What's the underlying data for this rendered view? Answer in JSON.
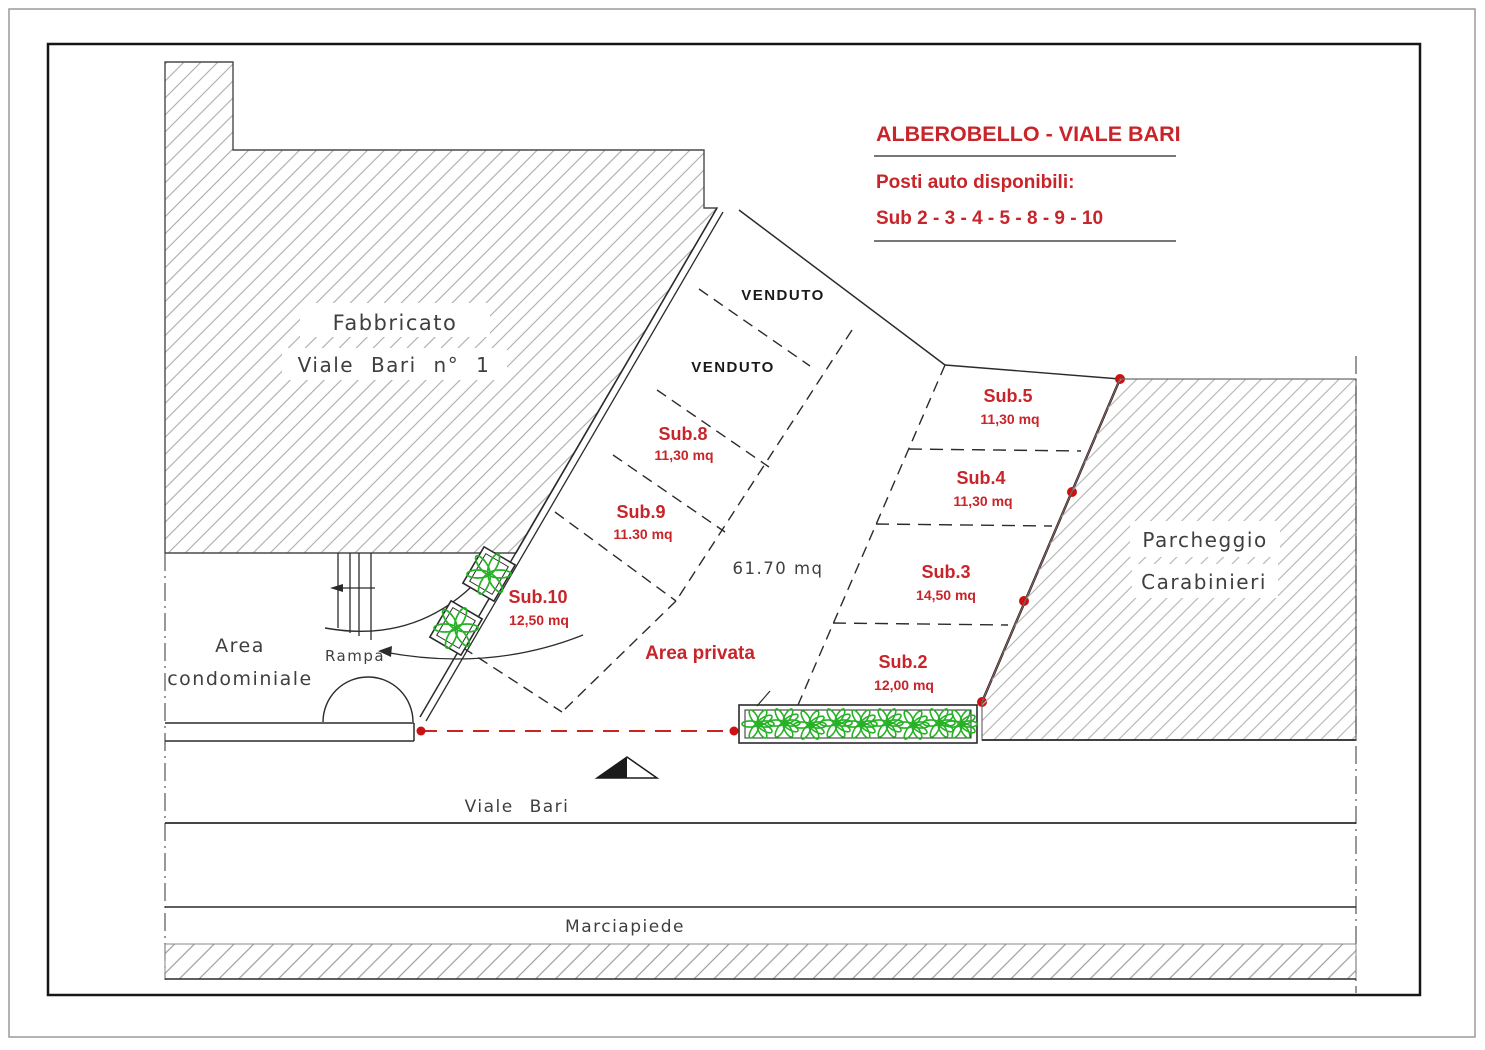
{
  "drawing": {
    "kind": "cadastral parking site plan",
    "title_block": {
      "line1": "ALBEROBELLO - VIALE BARI",
      "line2": "Posti auto disponibili:",
      "line3": "Sub 2 - 3 - 4 - 5 - 8 - 9 - 10"
    },
    "building": {
      "label_line1": "Fabbricato",
      "label_line2": "Viale Bari n° 1"
    },
    "zones": {
      "area_condominiale_line1": "Area",
      "area_condominiale_line2": "condominiale",
      "rampa": "Rampa",
      "area_privata": "Area privata",
      "open_area_size": "61.70  mq",
      "parcheggio_line1": "Parcheggio",
      "parcheggio_line2": "Carabinieri",
      "viale_bari": "Viale  Bari",
      "marciapiede": "Marciapiede"
    },
    "parcels": [
      {
        "label": "VENDUTO",
        "area": "",
        "status": "sold"
      },
      {
        "label": "VENDUTO",
        "area": "",
        "status": "sold"
      },
      {
        "label": "Sub.8",
        "area": "11,30 mq",
        "status": "available"
      },
      {
        "label": "Sub.9",
        "area": "11.30 mq",
        "status": "available"
      },
      {
        "label": "Sub.10",
        "area": "12,50 mq",
        "status": "available"
      },
      {
        "label": "Sub.5",
        "area": "11,30 mq",
        "status": "available"
      },
      {
        "label": "Sub.4",
        "area": "11,30 mq",
        "status": "available"
      },
      {
        "label": "Sub.3",
        "area": "14,50 mq",
        "status": "available"
      },
      {
        "label": "Sub.2",
        "area": "12,00 mq",
        "status": "available"
      }
    ],
    "colors": {
      "red_label": "#c8252b",
      "boundary_maroon": "#3d0f0f",
      "marker_red": "#cc1111",
      "hedge_green": "#27b127",
      "hatch_gray": "#ababab",
      "line_black": "#2b2b2b"
    }
  }
}
